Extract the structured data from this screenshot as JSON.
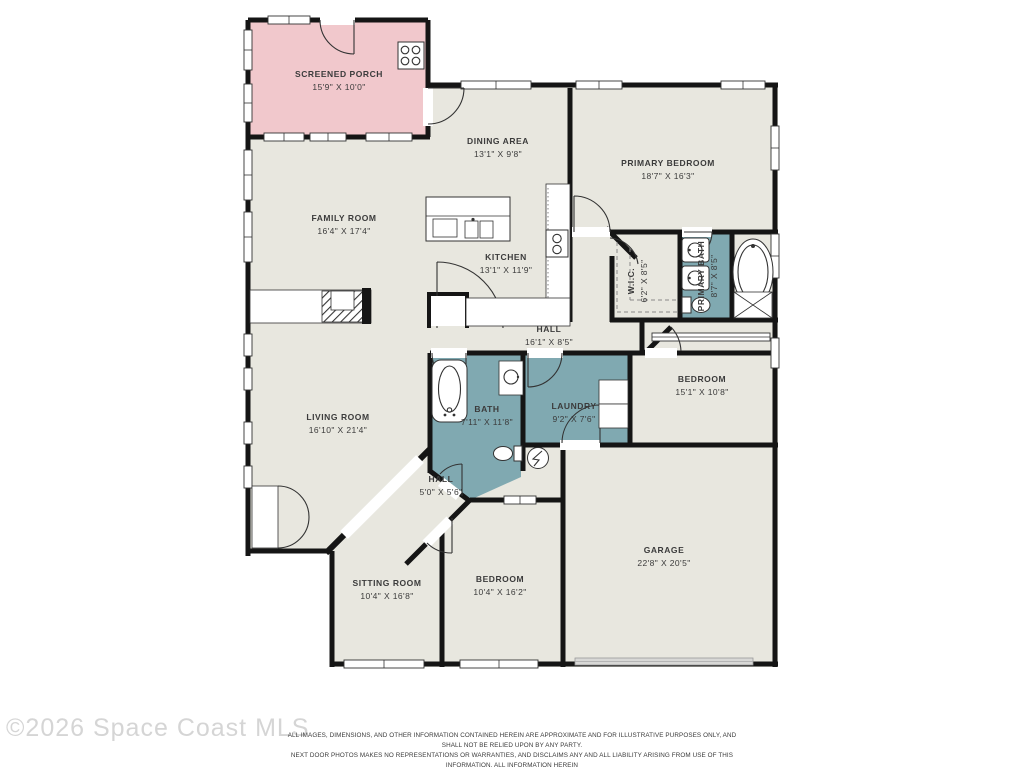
{
  "watermark": "©2026 Space Coast MLS",
  "disclaimer": {
    "line1": "ALL IMAGES, DIMENSIONS, AND OTHER INFORMATION CONTAINED HEREIN ARE APPROXIMATE AND FOR ILLUSTRATIVE PURPOSES ONLY, AND SHALL NOT BE RELIED UPON BY ANY PARTY.",
    "line2": "NEXT DOOR PHOTOS MAKES NO REPRESENTATIONS OR WARRANTIES, AND DISCLAIMS ANY AND ALL LIABILITY ARISING FROM USE OF THIS INFORMATION. ALL INFORMATION HEREIN",
    "line3": "SHALL BE SUBJECT TO THE TERMS AND CONDITIONS FOUND AT NEXTDOORPHOTOS.COM/TC."
  },
  "colors": {
    "floor": "#e8e7df",
    "porch": "#f1c8cc",
    "wet_rooms": "#80a9b1",
    "walls": "#151515",
    "watermark": "#d5d5d5"
  },
  "icons": {
    "grill": "grill-icon",
    "water_heater": "water-heater-icon",
    "fireplace": "fireplace-icon"
  },
  "rooms": {
    "screened_porch": {
      "name": "SCREENED PORCH",
      "dims": "15'9\" X 10'0\""
    },
    "dining_area": {
      "name": "DINING AREA",
      "dims": "13'1\" X 9'8\""
    },
    "primary_bedroom": {
      "name": "PRIMARY BEDROOM",
      "dims": "18'7\" X 16'3\""
    },
    "family_room": {
      "name": "FAMILY ROOM",
      "dims": "16'4\" X 17'4\""
    },
    "kitchen": {
      "name": "KITCHEN",
      "dims": "13'1\" X 11'9\""
    },
    "wic": {
      "name": "W.I.C.",
      "dims": "6'2\" X 8'5\""
    },
    "primary_bath": {
      "name": "PRIMARY BATH",
      "dims": "8'7\" X 8'5\""
    },
    "hall": {
      "name": "HALL",
      "dims": "16'1\" X 8'5\""
    },
    "bedroom2": {
      "name": "BEDROOM",
      "dims": "15'1\" X 10'8\""
    },
    "living_room": {
      "name": "LIVING ROOM",
      "dims": "16'10\" X 21'4\""
    },
    "bath": {
      "name": "BATH",
      "dims": "7'11\" X 11'8\""
    },
    "laundry": {
      "name": "LAUNDRY",
      "dims": "9'2\" X 7'6\""
    },
    "hall2": {
      "name": "HALL",
      "dims": "5'0\" X 5'6\""
    },
    "sitting_room": {
      "name": "SITTING ROOM",
      "dims": "10'4\" X 16'8\""
    },
    "bedroom3": {
      "name": "BEDROOM",
      "dims": "10'4\" X 16'2\""
    },
    "garage": {
      "name": "GARAGE",
      "dims": "22'8\" X 20'5\""
    }
  }
}
